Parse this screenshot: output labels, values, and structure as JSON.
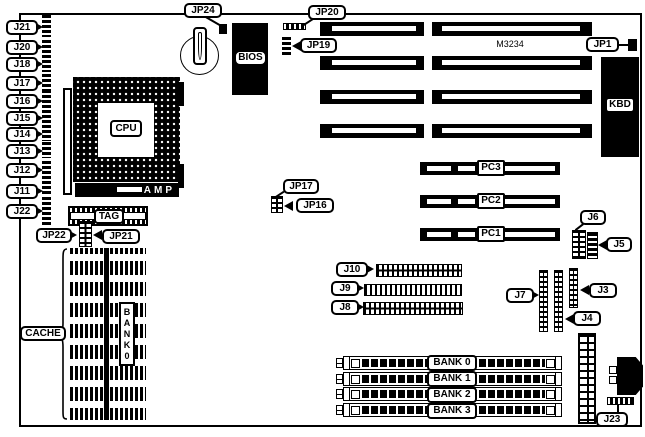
{
  "diagram": {
    "chip_text": "M3234",
    "cpu_label": "CPU",
    "amp_label": "AMP",
    "tag_label": "TAG",
    "bios_label": "BIOS",
    "kbd_label": "KBD",
    "cache_label": "CACHE",
    "cache_bank_letters": [
      "B",
      "A",
      "N",
      "K",
      "0"
    ],
    "left_jumpers": [
      "J21",
      "J20",
      "J18",
      "J17",
      "J16",
      "J15",
      "J14",
      "J13",
      "J12",
      "J11",
      "J22"
    ],
    "callouts": {
      "jp24": "JP24",
      "jp20": "JP20",
      "jp19": "JP19",
      "jp1": "JP1",
      "jp22": "JP22",
      "jp21": "JP21",
      "jp17": "JP17",
      "jp16": "JP16",
      "j10": "J10",
      "j9": "J9",
      "j8": "J8",
      "j7": "J7",
      "j3": "J3",
      "j4": "J4",
      "j6": "J6",
      "j5": "J5",
      "j23": "J23"
    },
    "pci_slots": [
      "PC3",
      "PC2",
      "PC1"
    ],
    "memory_banks": [
      "BANK 0",
      "BANK 1",
      "BANK 2",
      "BANK 3"
    ]
  }
}
